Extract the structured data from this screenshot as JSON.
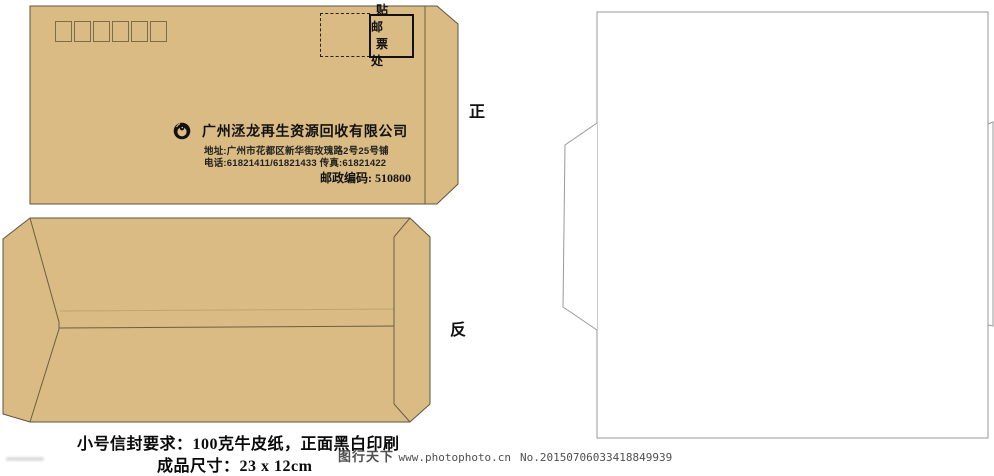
{
  "colors": {
    "kraft_paper": "#d9bb83",
    "outline": "#5f5640",
    "dieline_gray": "#999999",
    "ink": "#111111",
    "watermark_gray": "#4f4f4f"
  },
  "front": {
    "side_label": "正",
    "postal_code_boxes": 6,
    "stamp_area": {
      "row1": "贴 邮",
      "row2": "票 处"
    },
    "logo": "dragon-circle-logo",
    "company_name": "广州洆龙再生资源回收有限公司",
    "address_line": "地址:广州市花都区新华街玫瑰路2号25号铺",
    "phone_line": "电话:61821411/61821433  传真:61821422",
    "postal_code_line": "邮政编码: 510800"
  },
  "back": {
    "side_label": "反"
  },
  "spec_notes": {
    "line1": "小号信封要求：100克牛皮纸，正面黑白印刷",
    "line2": "成品尺寸：23 x 12cm"
  },
  "watermark": {
    "brand": "图行天下",
    "site": "www.photophoto.cn",
    "serial": "No.20150706033418849939"
  }
}
